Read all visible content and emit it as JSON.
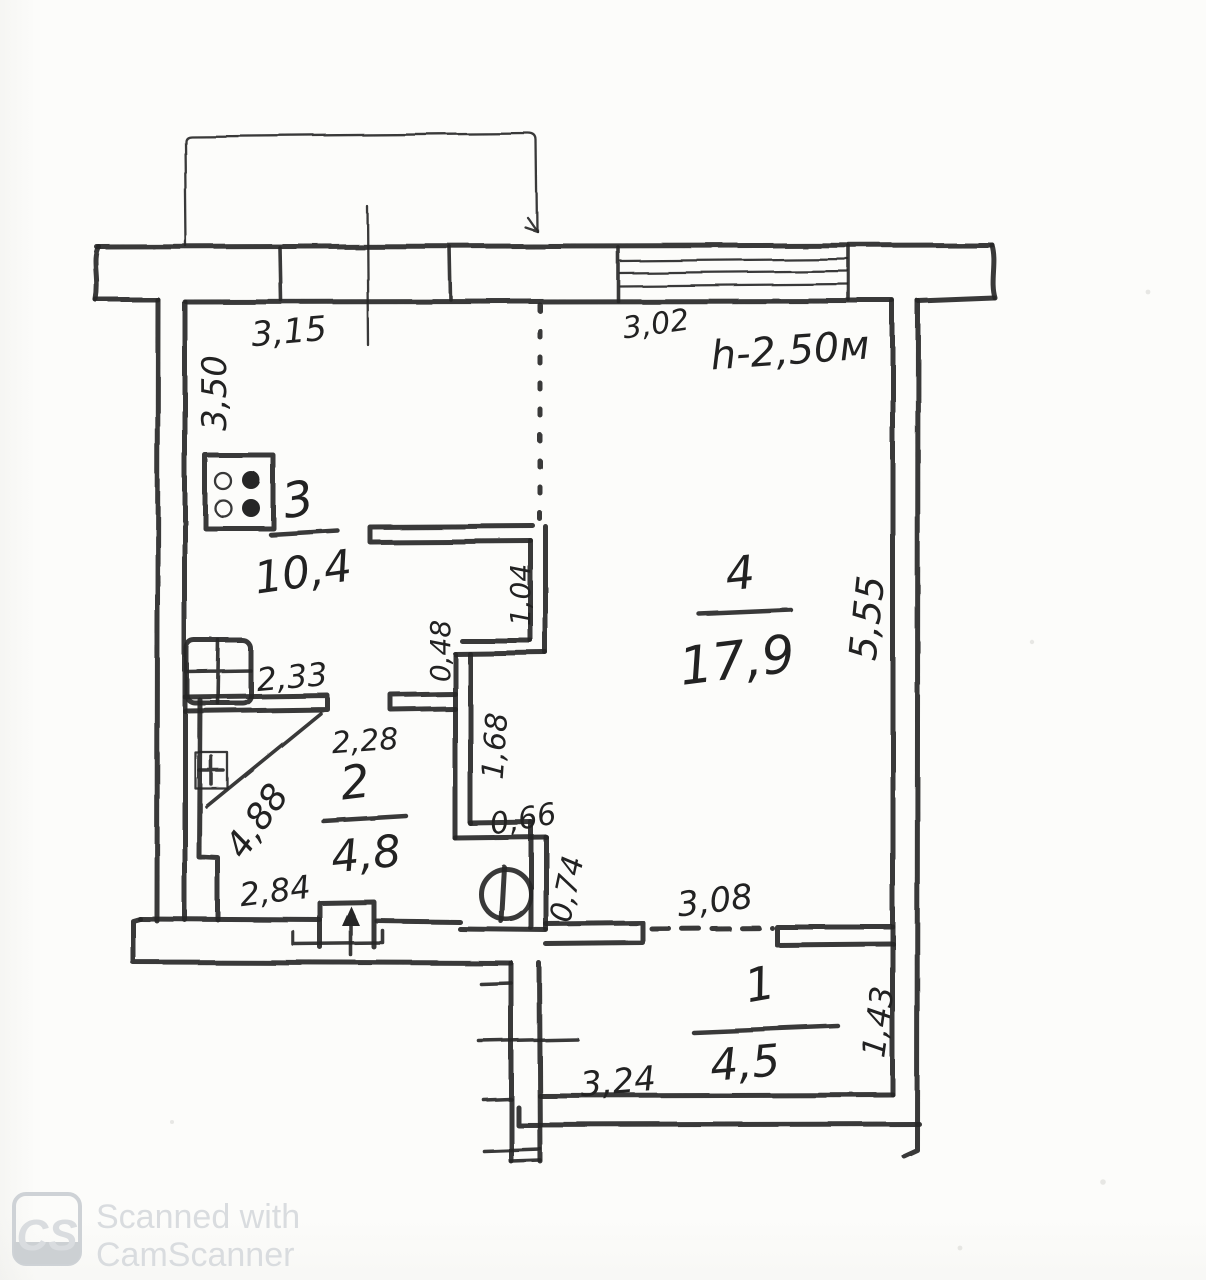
{
  "plan": {
    "note_height": "h-2,50м",
    "rooms": [
      {
        "number": "1",
        "area": "4,5"
      },
      {
        "number": "2",
        "area": "4,8"
      },
      {
        "number": "3",
        "area": "10,4"
      },
      {
        "number": "4",
        "area": "17,9"
      }
    ],
    "dims": {
      "w315": "3,15",
      "w302": "3,02",
      "h350": "3,50",
      "h555": "5,55",
      "w233": "2,33",
      "v104": "1,04",
      "v048": "0,48",
      "w228": "2,28",
      "d488": "4,88",
      "w284": "2,84",
      "v168": "1,68",
      "w066": "0,66",
      "v074": "0,74",
      "w308": "3,08",
      "w324": "3,24",
      "v143": "1,43"
    }
  },
  "watermark": {
    "logo_text": "CS",
    "line1": "Scanned with",
    "line2": "CamScanner"
  }
}
